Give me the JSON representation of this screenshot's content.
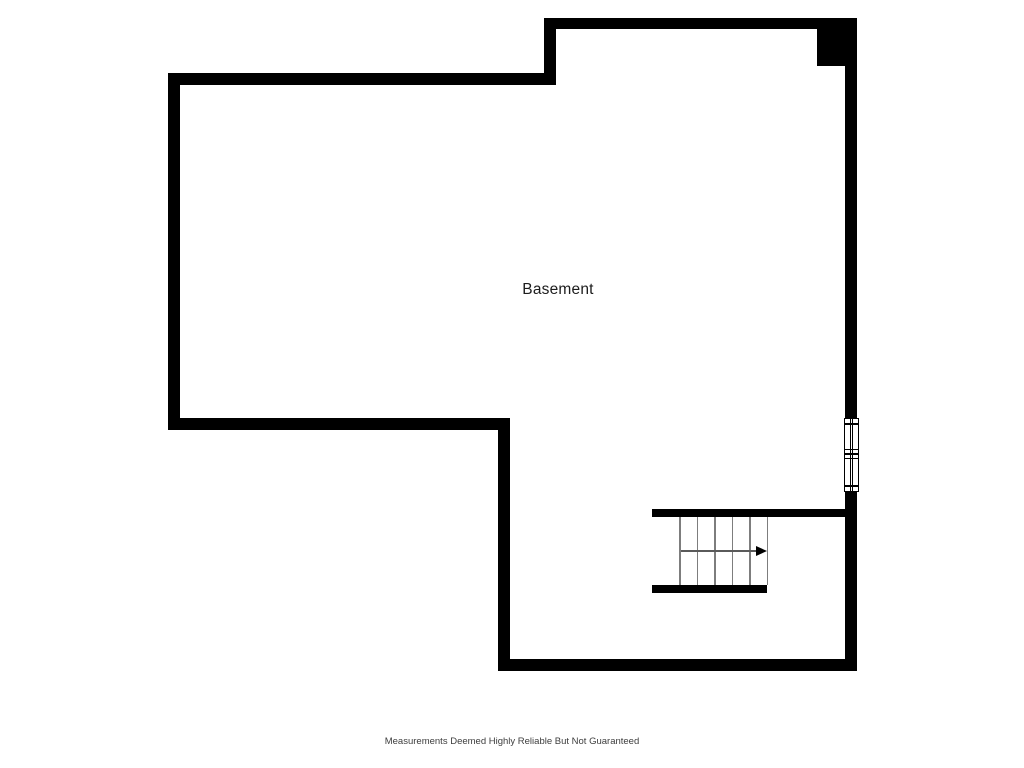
{
  "floorplan": {
    "room_label": "Basement",
    "disclaimer": "Measurements Deemed Highly Reliable But Not Guaranteed",
    "colors": {
      "wall": "#000000",
      "background": "#ffffff",
      "stair_tread": "#7d7d7d",
      "room_label_text": "#1c1c1c",
      "disclaimer_text": "#3d3d3d"
    },
    "stairs": {
      "tread_count": 6,
      "direction_arrow": "right"
    },
    "window": {
      "symbol": "double-window",
      "location": "right-wall"
    }
  }
}
